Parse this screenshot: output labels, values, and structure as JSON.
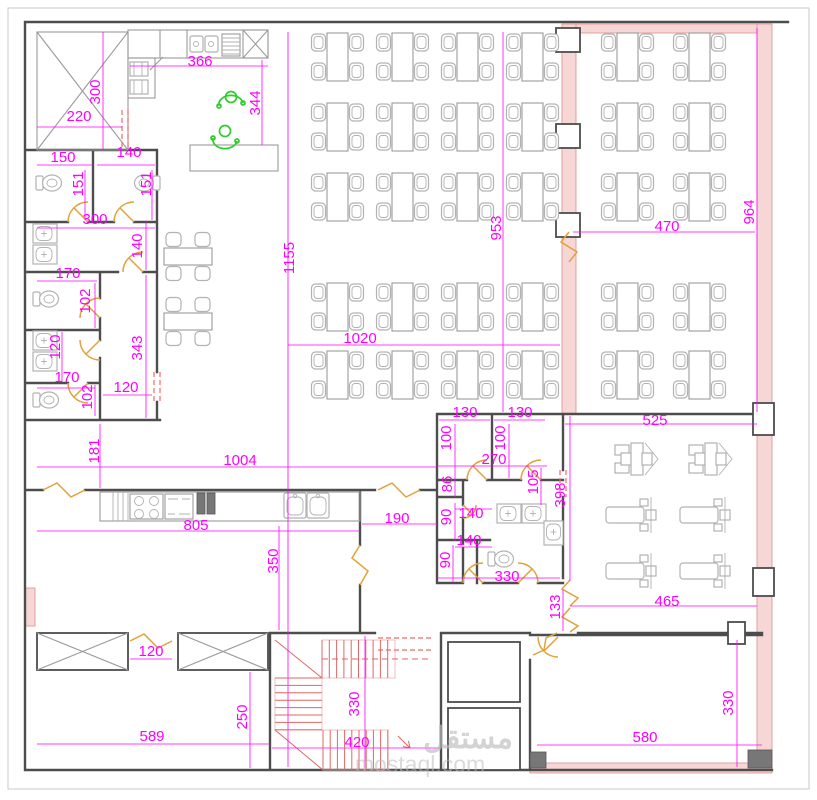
{
  "drawing": {
    "kind": "architectural floor plan",
    "watermark": {
      "arabic": "مستقل",
      "latin": "mostaql.com"
    }
  },
  "colors": {
    "dimension": "#ff00ff",
    "wall": "#4d4d4d",
    "light_line": "#9a9a9a",
    "furniture": "#b2b2b2",
    "door": "#e2a13a",
    "stair": "#e06666",
    "dashed_opening": "#ef6a6a",
    "wall_fill": "#f7d6d6",
    "wall_fill_edge": "#e09999",
    "people": "#2ecc2e",
    "watermark": "#bdbdbd"
  },
  "furniture_counts": {
    "main_dining_tables": 20,
    "right_dining_tables": 10,
    "side_tables": 2,
    "gym_machines": 6,
    "people": 2
  },
  "dimension_labels": [
    {
      "t": "366",
      "x": 200,
      "y": 62
    },
    {
      "t": "300",
      "x": 96,
      "y": 92,
      "v": 1
    },
    {
      "t": "220",
      "x": 79,
      "y": 117
    },
    {
      "t": "344",
      "x": 256,
      "y": 103,
      "v": 1
    },
    {
      "t": "150",
      "x": 63,
      "y": 158
    },
    {
      "t": "140",
      "x": 129,
      "y": 153
    },
    {
      "t": "151",
      "x": 79,
      "y": 184,
      "v": 1
    },
    {
      "t": "151",
      "x": 147,
      "y": 184,
      "v": 1
    },
    {
      "t": "300",
      "x": 95,
      "y": 220
    },
    {
      "t": "140",
      "x": 138,
      "y": 246,
      "v": 1
    },
    {
      "t": "170",
      "x": 68,
      "y": 274
    },
    {
      "t": "102",
      "x": 86,
      "y": 301,
      "v": 1
    },
    {
      "t": "343",
      "x": 138,
      "y": 348,
      "v": 1
    },
    {
      "t": "120",
      "x": 56,
      "y": 347,
      "v": 1
    },
    {
      "t": "170",
      "x": 67,
      "y": 378
    },
    {
      "t": "102",
      "x": 88,
      "y": 397,
      "v": 1
    },
    {
      "t": "120",
      "x": 126,
      "y": 388
    },
    {
      "t": "181",
      "x": 95,
      "y": 451,
      "v": 1
    },
    {
      "t": "1155",
      "x": 290,
      "y": 258,
      "v": 1
    },
    {
      "t": "953",
      "x": 497,
      "y": 228,
      "v": 1
    },
    {
      "t": "1020",
      "x": 360,
      "y": 339
    },
    {
      "t": "470",
      "x": 667,
      "y": 227
    },
    {
      "t": "964",
      "x": 750,
      "y": 212,
      "v": 1
    },
    {
      "t": "525",
      "x": 655,
      "y": 421
    },
    {
      "t": "398",
      "x": 561,
      "y": 495,
      "v": 1
    },
    {
      "t": "465",
      "x": 667,
      "y": 602
    },
    {
      "t": "130",
      "x": 465,
      "y": 413
    },
    {
      "t": "130",
      "x": 520,
      "y": 413
    },
    {
      "t": "100",
      "x": 447,
      "y": 438,
      "v": 1
    },
    {
      "t": "100",
      "x": 501,
      "y": 438,
      "v": 1
    },
    {
      "t": "270",
      "x": 494,
      "y": 460
    },
    {
      "t": "86",
      "x": 448,
      "y": 484,
      "v": 1
    },
    {
      "t": "105",
      "x": 534,
      "y": 482,
      "v": 1
    },
    {
      "t": "90",
      "x": 447,
      "y": 517,
      "v": 1
    },
    {
      "t": "140",
      "x": 471,
      "y": 514
    },
    {
      "t": "140",
      "x": 469,
      "y": 541
    },
    {
      "t": "90",
      "x": 446,
      "y": 560,
      "v": 1
    },
    {
      "t": "330",
      "x": 507,
      "y": 577
    },
    {
      "t": "133",
      "x": 556,
      "y": 607,
      "v": 1
    },
    {
      "t": "1004",
      "x": 240,
      "y": 461
    },
    {
      "t": "805",
      "x": 196,
      "y": 526
    },
    {
      "t": "190",
      "x": 397,
      "y": 519
    },
    {
      "t": "350",
      "x": 274,
      "y": 561,
      "v": 1
    },
    {
      "t": "120",
      "x": 151,
      "y": 652
    },
    {
      "t": "250",
      "x": 243,
      "y": 717,
      "v": 1
    },
    {
      "t": "589",
      "x": 152,
      "y": 737
    },
    {
      "t": "330",
      "x": 355,
      "y": 704,
      "v": 1
    },
    {
      "t": "420",
      "x": 357,
      "y": 743
    },
    {
      "t": "330",
      "x": 729,
      "y": 703,
      "v": 1
    },
    {
      "t": "580",
      "x": 645,
      "y": 738
    }
  ]
}
